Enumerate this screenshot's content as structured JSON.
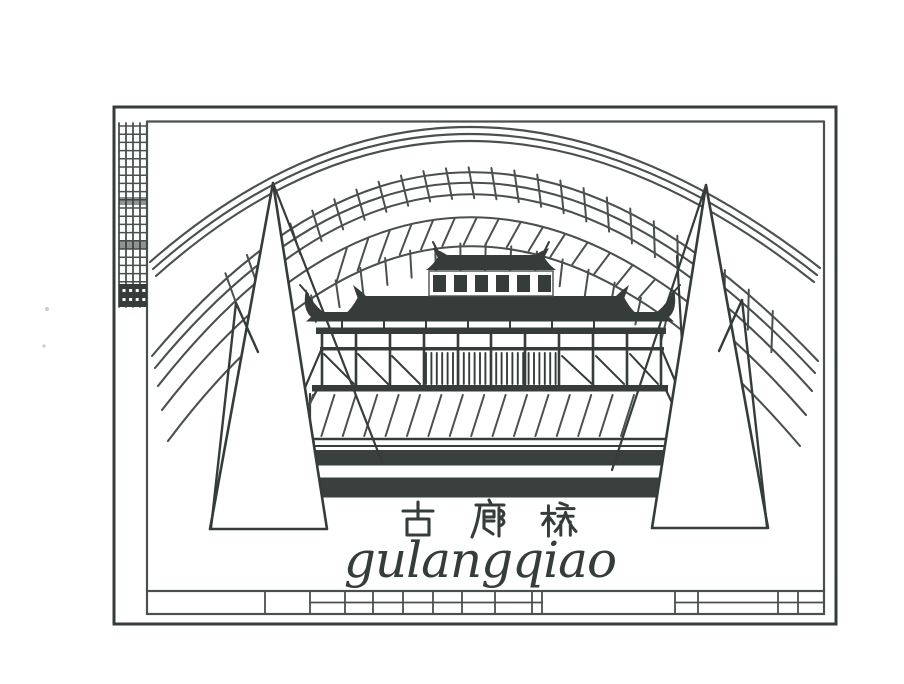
{
  "artwork": {
    "title_cn": "古廊桥",
    "title_cn_chars": [
      "古",
      "廊",
      "桥"
    ],
    "title_pinyin": "gulangqiao"
  },
  "colors": {
    "ink": "#363c3a",
    "line": "#4a504d",
    "band": "#3a403e",
    "paper": "#ffffff"
  }
}
